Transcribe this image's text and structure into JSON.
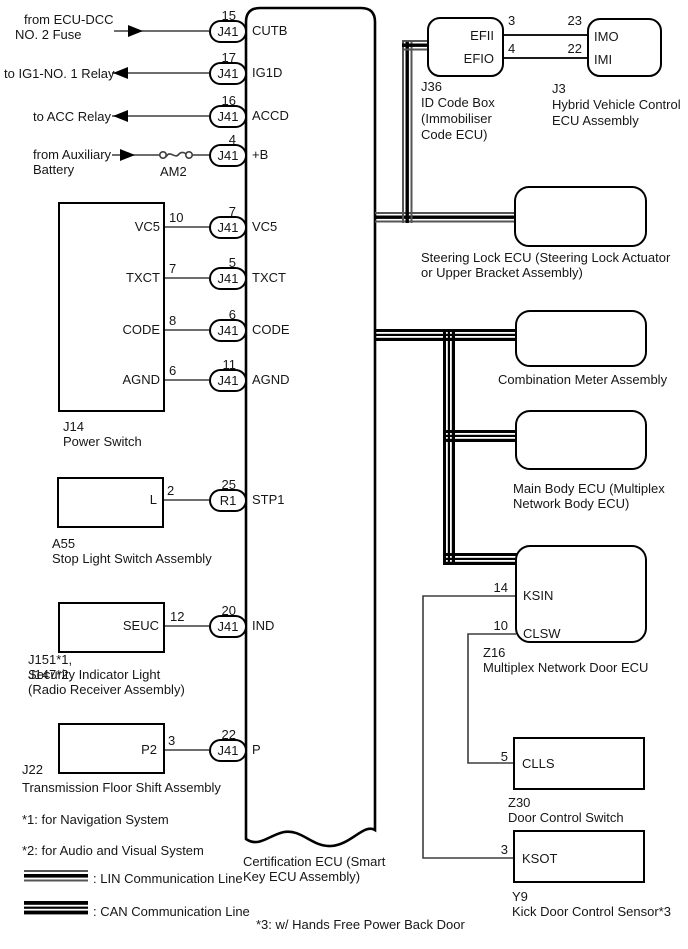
{
  "diagram": {
    "ecu": {
      "id_label_line1": "Certification ECU (Smart",
      "id_label_line2": "Key ECU Assembly)"
    },
    "left_rows": [
      {
        "line1": "from ECU-DCC",
        "line2": "NO. 2 Fuse",
        "direction": "in",
        "conn": "J41",
        "conn_pin": "15",
        "ecu_pin": "CUTB"
      },
      {
        "line1": "to IG1-NO. 1 Relay",
        "direction": "out",
        "conn": "J41",
        "conn_pin": "17",
        "ecu_pin": "IG1D"
      },
      {
        "line1": "to ACC Relay",
        "direction": "out",
        "conn": "J41",
        "conn_pin": "16",
        "ecu_pin": "ACCD"
      },
      {
        "line1": "from Auxiliary",
        "line2": "Battery",
        "direction": "in",
        "fuse": "AM2",
        "conn": "J41",
        "conn_pin": "4",
        "ecu_pin": "+B"
      }
    ],
    "j14": {
      "id": "J14",
      "label": "Power Switch",
      "pins": [
        {
          "pin": "VC5",
          "pin_num": "10",
          "conn": "J41",
          "conn_pin": "7",
          "ecu_pin": "VC5"
        },
        {
          "pin": "TXCT",
          "pin_num": "7",
          "conn": "J41",
          "conn_pin": "5",
          "ecu_pin": "TXCT"
        },
        {
          "pin": "CODE",
          "pin_num": "8",
          "conn": "J41",
          "conn_pin": "6",
          "ecu_pin": "CODE"
        },
        {
          "pin": "AGND",
          "pin_num": "6",
          "conn": "J41",
          "conn_pin": "11",
          "ecu_pin": "AGND"
        }
      ]
    },
    "a55": {
      "id": "A55",
      "label": "Stop Light Switch Assembly",
      "pin": "L",
      "pin_num": "2",
      "conn": "R1",
      "conn_pin": "25",
      "ecu_pin": "STP1"
    },
    "j151": {
      "id_line1": "J151*1,",
      "id_line2": "J147*2",
      "label_overlap": "Security Indicator Light",
      "label2": "(Radio Receiver Assembly)",
      "pin": "SEUC",
      "pin_num": "12",
      "conn": "J41",
      "conn_pin": "20",
      "ecu_pin": "IND"
    },
    "j22": {
      "id": "J22",
      "label": "Transmission Floor Shift Assembly",
      "pin": "P2",
      "pin_num": "3",
      "conn": "J41",
      "conn_pin": "22",
      "ecu_pin": "P"
    },
    "j36": {
      "id": "J36",
      "label_line1": "ID Code Box",
      "label_line2": "(Immobiliser",
      "label_line3": "Code ECU)",
      "pin1": "EFII",
      "pin1_num": "3",
      "pin2": "EFIO",
      "pin2_num": "4"
    },
    "j3": {
      "id": "J3",
      "label_line1": "Hybrid Vehicle Control",
      "label_line2": "ECU Assembly",
      "pin1": "IMO",
      "pin1_num": "23",
      "pin2": "IMI",
      "pin2_num": "22"
    },
    "steering_lock": {
      "label_line1": "Steering Lock ECU (Steering Lock Actuator",
      "label_line2": "or Upper Bracket Assembly)"
    },
    "combination_meter": {
      "label": "Combination Meter Assembly"
    },
    "main_body": {
      "label_line1": "Main Body ECU (Multiplex",
      "label_line2": "Network Body ECU)"
    },
    "z16": {
      "id": "Z16",
      "label": "Multiplex Network Door ECU",
      "pin1": "KSIN",
      "pin1_num": "14",
      "pin2": "CLSW",
      "pin2_num": "10"
    },
    "z30": {
      "id": "Z30",
      "label": "Door Control Switch",
      "pin": "CLLS",
      "pin_num": "5"
    },
    "y9": {
      "id": "Y9",
      "label": "Kick Door Control Sensor*3",
      "pin": "KSOT",
      "pin_num": "3"
    },
    "notes": {
      "note1": "*1: for Navigation System",
      "note2": "*2: for Audio and Visual System",
      "note3": "*3: w/ Hands Free Power Back Door"
    },
    "legend": {
      "lin": ": LIN Communication Line",
      "can": ": CAN Communication Line"
    },
    "colors": {
      "ink": "#000000",
      "paper": "#ffffff"
    }
  }
}
